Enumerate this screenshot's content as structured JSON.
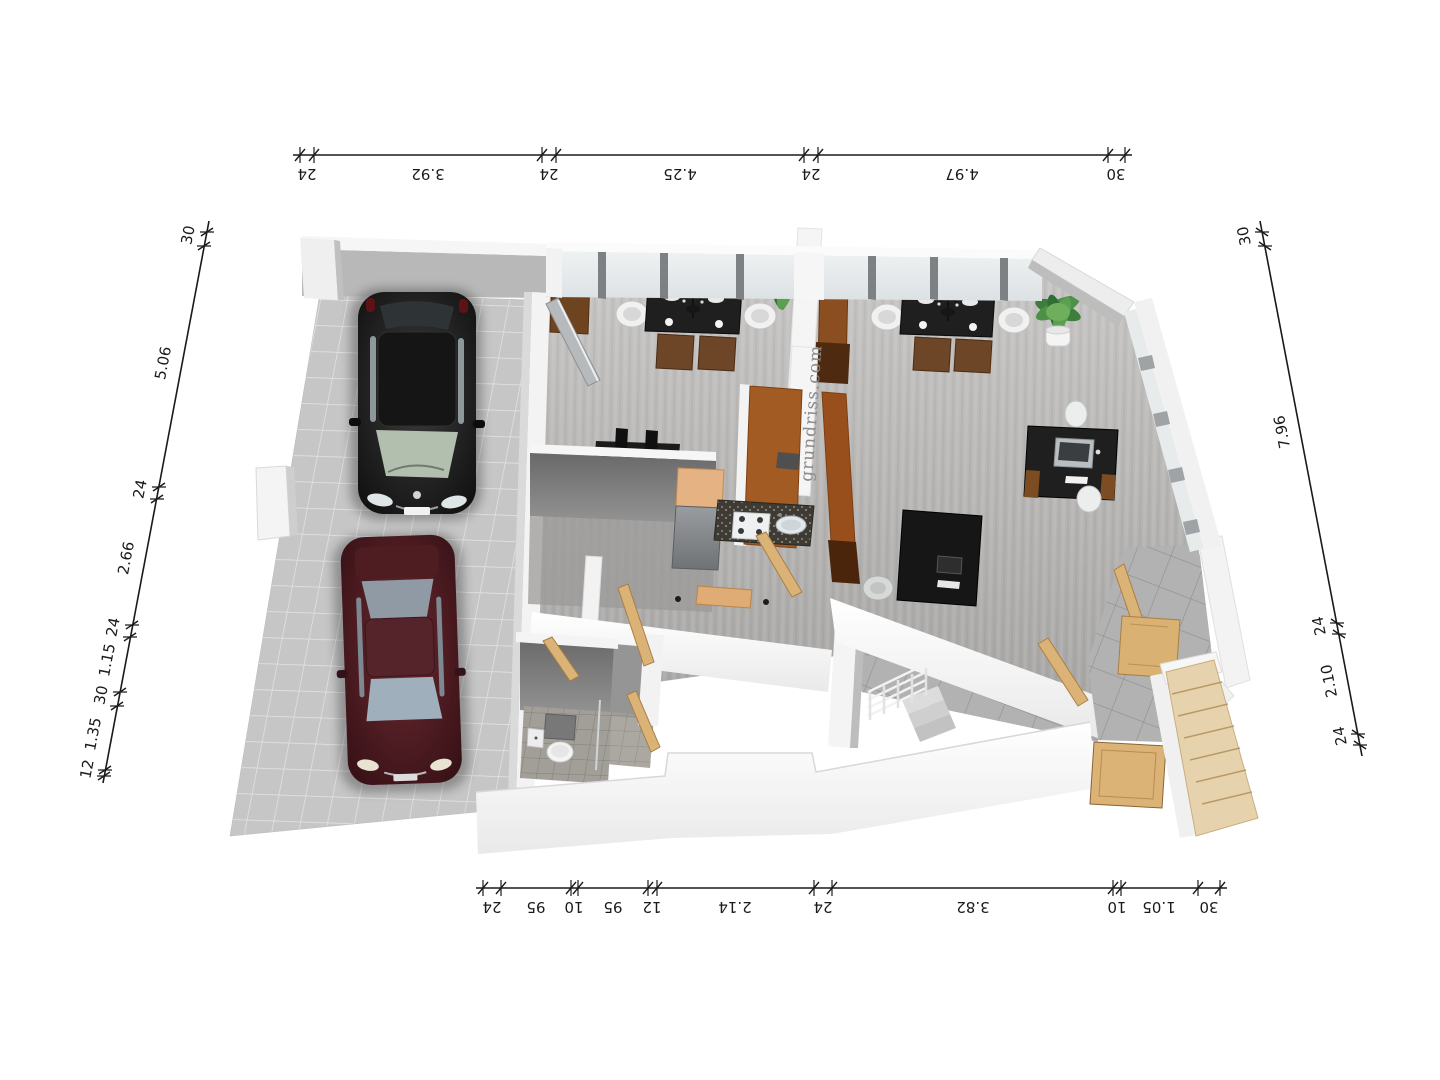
{
  "watermark": {
    "text": "grundriss.com",
    "color": "#8c8c8c"
  },
  "dims": {
    "top": [
      "24",
      "3.92",
      "24",
      "4.25",
      "24",
      "4.97",
      "30"
    ],
    "bottom": [
      "24",
      "95",
      "10",
      "95",
      "12",
      "2.14",
      "24",
      "3.82",
      "10",
      "1.05",
      "30"
    ],
    "left": [
      "30",
      "5.06",
      "24",
      "2.66",
      "24",
      "1.15",
      "30",
      "1.35",
      "12"
    ],
    "right": [
      "30",
      "7.96",
      "24",
      "2.10",
      "24"
    ]
  },
  "colors": {
    "wall": "#f5f5f5",
    "wall_shadow": "#8a8a8a",
    "floor_laminate": "#b4b3b1",
    "driveway_tile": "#c6c6c6",
    "porch_tile": "#b2b2b2",
    "bath_tile": "#a29e98",
    "wood_door": "#dcb377",
    "wood_counter": "#a25b23",
    "furniture_black": "#1d1d1d",
    "glass": "#e9ecee",
    "car_black": "#141414",
    "car_red": "#4a1a20",
    "plant_green": "#3f7d3a",
    "dim_line": "#1a1a1a"
  },
  "scene": {
    "type": "3d-floor-plan-render",
    "objects": [
      "driveway",
      "carport",
      "black-suv",
      "maroon-sedan",
      "dining-table-left",
      "dining-table-right",
      "monitor-desk",
      "computer-desk",
      "reception-desk",
      "kitchen-block",
      "sink",
      "range",
      "fridge",
      "room-divider-counter",
      "sideboard",
      "tall-cabinet",
      "potted-plant-left",
      "potted-plant-right",
      "toilet",
      "wash-basin",
      "interior-doors",
      "entry-door",
      "outdoor-stairs",
      "basement-stair-railing",
      "window-front",
      "window-side",
      "watermark"
    ]
  }
}
